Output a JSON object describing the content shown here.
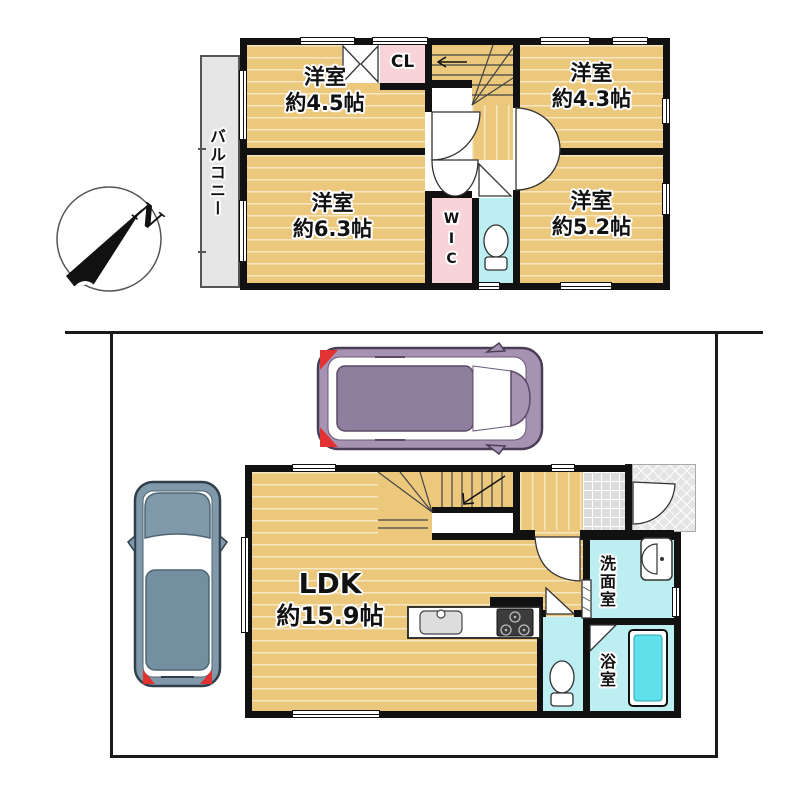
{
  "compass": {
    "north_label": "N"
  },
  "floor2": {
    "balcony_label": "バルコニー",
    "rooms": [
      {
        "name": "洋室",
        "size": "約4.5帖"
      },
      {
        "name": "洋室",
        "size": "約4.3帖"
      },
      {
        "name": "洋室",
        "size": "約6.3帖"
      },
      {
        "name": "洋室",
        "size": "約5.2帖"
      }
    ],
    "closet_label": "CL",
    "wic_label": "WIC"
  },
  "floor1": {
    "ldk_name": "LDK",
    "ldk_size": "約15.9帖",
    "washroom_label": "洗面室",
    "bathroom_label": "浴室"
  },
  "colors": {
    "room_fill": "#ebc87c",
    "closet_fill": "#f8d4d9",
    "wet_area_fill": "#bceef2",
    "tub_fill": "#5fe0ea",
    "wall": "#111111",
    "balcony_fill": "#e6e6e6",
    "car_top": "#a692b2",
    "car_left": "#8099aa",
    "taillight": "#e23333"
  }
}
